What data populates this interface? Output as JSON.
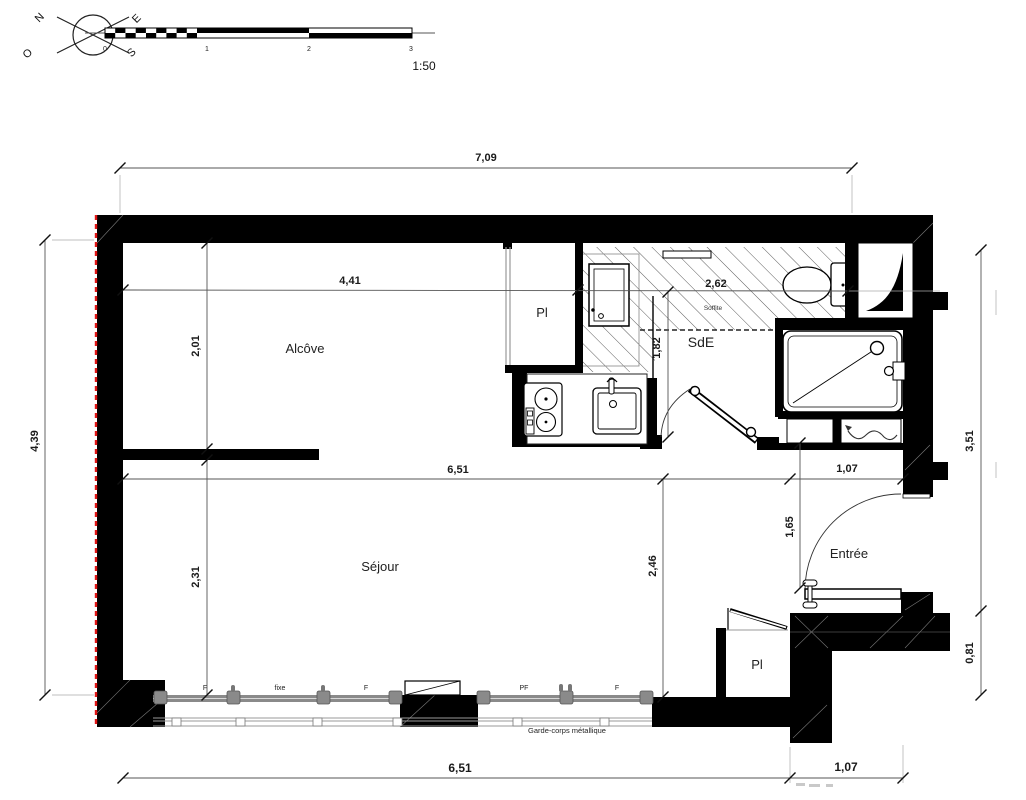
{
  "compass": {
    "north": "N",
    "east": "E",
    "south": "S",
    "west": "O"
  },
  "scale": {
    "ticks": [
      "0",
      "1",
      "2",
      "3"
    ],
    "ratio": "1:50"
  },
  "rooms": {
    "alcove": "Alcôve",
    "sejour": "Séjour",
    "shower_room": "SdE",
    "entry": "Entrée",
    "closet_top": "Pl",
    "closet_bottom": "Pl",
    "soffit": "Soffite"
  },
  "dims": {
    "top_total": "7,09",
    "alcove_width": "4,41",
    "soffit_width": "2,62",
    "alcove_depth": "2,01",
    "sde_depth": "1,82",
    "sejour_width": "6,51",
    "entry_width": "1,07",
    "left_total": "4,39",
    "sejour_depth_upper": "2,31",
    "sejour_depth": "2,46",
    "entry_depth": "1,65",
    "right_upper": "3,51",
    "right_lower": "0,81",
    "bottom_sejour_width": "6,51",
    "bottom_entry_width": "1,07"
  },
  "windows": {
    "f1": "F",
    "fixed": "fixe",
    "f2": "F",
    "pf": "PF",
    "f3": "F",
    "guardrail": "Garde-corps métallique"
  },
  "colors": {
    "wall": "#000000",
    "demolition_red": "#e01616",
    "frame_gray": "#8a8a8a"
  }
}
